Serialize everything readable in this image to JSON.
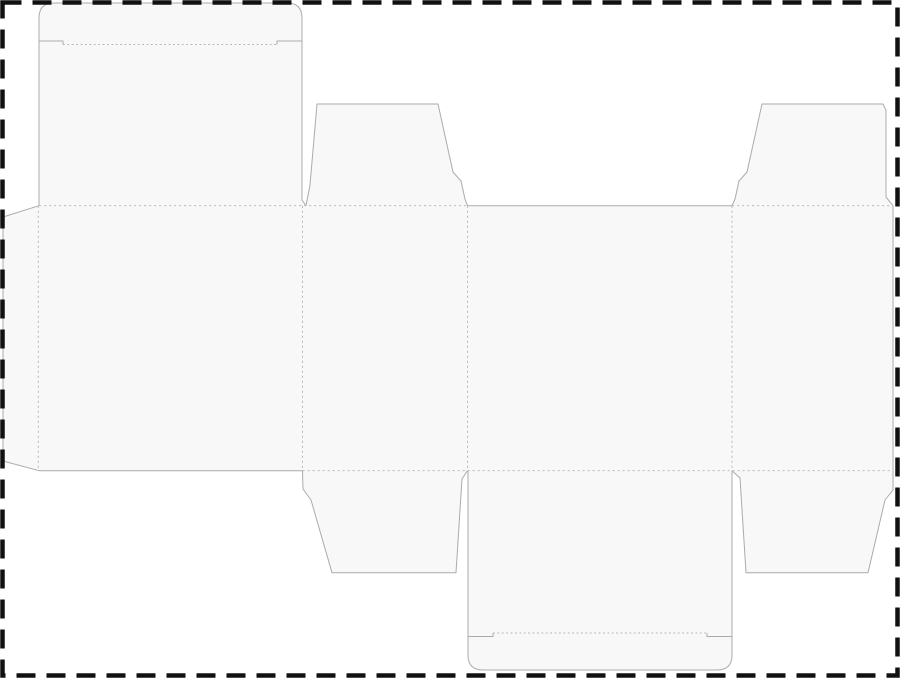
{
  "canvas": {
    "width": 900,
    "height": 678
  },
  "colors": {
    "background": "#ffffff",
    "panel_fill": "#f8f8f8",
    "cut_line": "#ababab",
    "fold_line": "#b4b4b4",
    "artboard_dash": "#111111"
  },
  "artboard_border": {
    "shape": "dashed-rectangle",
    "x": "2.5",
    "y": "2.5",
    "width": "895",
    "height": "673"
  },
  "dieline": {
    "description_names": {
      "regions": [
        "glue-flap",
        "main-body-panels",
        "top-tuck-lid",
        "top-dust-flap-left",
        "top-dust-flap-right",
        "bottom-dust-flap-left",
        "bottom-tuck-lid",
        "bottom-dust-flap-right"
      ]
    },
    "fills": {
      "main_body": "M 39,205.7 L 893,205.7 L 893,470.7 L 39,470.7 Z",
      "glue_flap": "M 39,205.7 L 3,217 L 3,461 L 39,470.7 Z",
      "top_lid": "M 39,205.7 L 39,18 Q 39,3 54,3 L 287,3 Q 302,3 302,18 L 302,200 L 306,205.7 Z",
      "top_mid_flap": "M 306,205.7 L 310,185 L 317,104 L 438,104 L 453,172 L 461,181 L 465,199 L 467.5,205.7 Z",
      "top_right_flap": "M 732,205.7 L 735,199 L 739,181 L 747,172 L 762,104 L 883,104 L 886,110 L 886,197 L 893,205.7 Z",
      "bottom_left_flap": "M 302.5,470.7 L 303,489 L 311,500 L 332,572.7 L 456,572.7 L 462,479 L 467.5,470.7 Z",
      "bottom_lid": "M 468,470.7 L 468,655 Q 468,670 483,670 L 717,670 Q 732,670 732,655 L 732,470.7 Z",
      "bottom_right_flap": "M 732,470.7 L 740,478 L 746,572.7 L 868,572.7 L 885,500 L 893,490 L 893,470.7 Z"
    },
    "cuts": {
      "glue_flap_edges": "M 39,205.7 L 3,217 L 3,461 L 39,470.7",
      "top_lid_outline": "M 39,205.7 L 39,18 Q 39,3 54,3 L 287,3 Q 302,3 302,18 L 302,200 L 306,205.7",
      "top_lid_slits": "M 39,41 L 63,41 L 63,44.5 M 302,41 L 277,41 L 277,44.5",
      "top_mid_flap_outline": "M 306,205.7 L 310,185 L 317,104 L 438,104 L 453,172 L 461,181 L 465,199 L 467.5,205.7",
      "top_right_flap_outline": "M 732,205.7 L 735,199 L 739,181 L 747,172 L 762,104 L 883,104 L 886,110 L 886,197 L 893,205.7",
      "panel3_top_edge": "M 467.5,205.7 L 732,205.7",
      "panel1_bottom_edge": "M 39,470.7 L 302.5,470.7",
      "sheet_right_edge": "M 893,205.7 L 893,470.7",
      "bottom_left_flap_outline": "M 302.5,470.7 L 303,489 L 311,500 L 332,572.7 L 456,572.7 L 462,479 L 467.5,470.7",
      "bottom_lid_outline": "M 468,470.7 L 468,655 Q 468,670 483,670 L 717,670 Q 732,670 732,655 L 732,470.7",
      "bottom_lid_slits": "M 468,636.5 L 493,636.5 L 493,633 M 732,636.5 L 707,636.5 L 707,633",
      "bottom_right_flap_outline": "M 732,470.7 L 740,478 L 746,572.7 L 868,572.7 L 885,500 L 893,490 L 893,470.7"
    },
    "folds": {
      "top_fold_left": "M 39,205.7 L 467.5,205.7",
      "top_fold_right": "M 732,205.7 L 892,205.7",
      "bottom_fold": "M 302.5,470.7 L 892,470.7",
      "glue_fold": "M 38.3,205.7 L 38.3,470.7",
      "panel1_2_fold": "M 302.5,205.7 L 302.5,470.7",
      "panel2_3_fold": "M 467.5,205.7 L 467.5,470.7",
      "panel3_4_fold": "M 732,205.7 L 732,470.7",
      "top_lid_crease": "M 63,44.5 L 277,44.5",
      "bottom_lid_crease": "M 493,633 L 707,633"
    }
  }
}
